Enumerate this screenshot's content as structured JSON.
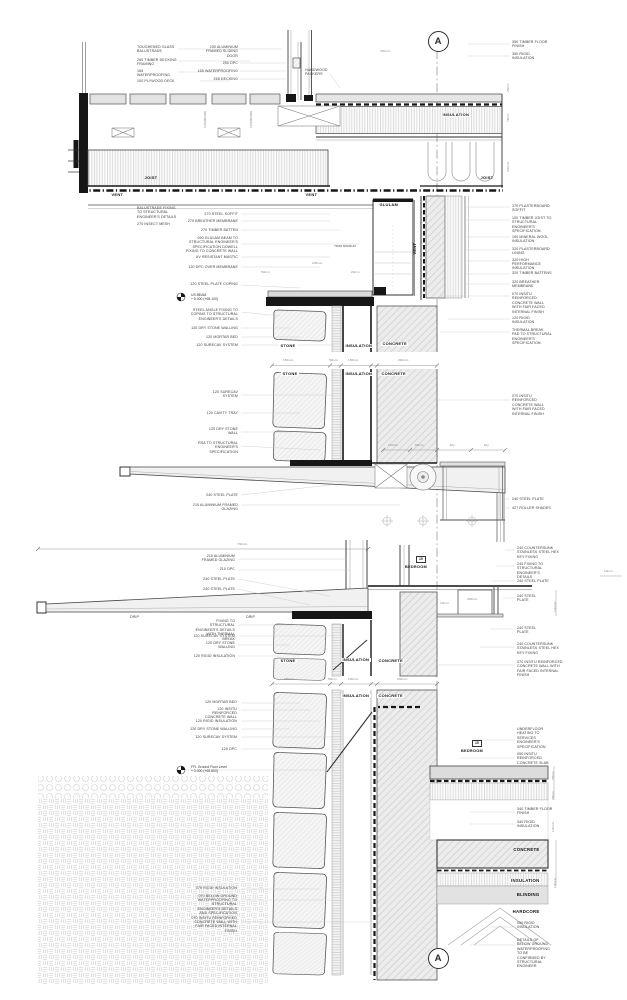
{
  "section_markers": {
    "top": "A",
    "bottom": "A"
  },
  "room": {
    "tag": "15",
    "name": "BEDROOM"
  },
  "material_labels": {
    "joist": "JOIST",
    "vent": "VENT",
    "insulation": "INSULATION",
    "glulam": "GLULAM",
    "stone": "STONE",
    "concrete": "CONCRETE",
    "blinding": "BLINDING",
    "hardcore": "HARDCORE",
    "min_note": "75MM MINIMUM"
  },
  "levels": {
    "us_beam": {
      "l1": "US BEAM",
      "l2": "+ 5.000 (+68.100)"
    },
    "ffl": {
      "l1": "FFL Ground Floor Level",
      "l2": "+ 3.000 (+65.800)"
    }
  },
  "annotations": {
    "deck": {
      "tl1": "TOUGHENED GLASS BALUSTRADE",
      "tl2": "265 TIMBER DECKING FRAMING",
      "tl3": "165 WATERPROOFING",
      "tl4": "100 PLYWOOD DECK",
      "tl5": "BALUSTRADE FIXING TO STRUCTURAL ENGINEER'S DETAILS",
      "tl6": "270 INSECT MESH"
    },
    "door": {
      "tm1": "200 ALUMINIUM FRAMED SLIDING DOOR",
      "tm2": "250 DPC",
      "tm3": "165 WATERPROOFING",
      "tm4": "265 DECKING",
      "tm5": "HARDWOOD PACKERS"
    },
    "floor_top": {
      "tr1": "350 TIMBER FLOOR FINISH",
      "tr2": "350 RIGID INSULATION"
    },
    "wall_right": {
      "r1": "370 PLASTERBOARD SOFFIT",
      "r2": "100 TIMBER JOIST TO STRUCTURAL ENGINEER'S SPECIFICATION",
      "r3": "100 MINERAL WOOL INSULATION",
      "r4": "320 PLASTERBOARD LINING",
      "r5": "320 HIGH PERFORMANCE INSULATION",
      "r6": "320 TIMBER BATTENS",
      "r7": "320 BREATHER MEMBRANE",
      "r8": "070 INSITU REINFORCED CONCRETE WALL WITH FAIR FACED INTERNAL FINISH",
      "r9": "120 RIGID INSULATION",
      "r10": "THERMAL BREAK PAD TO STRUCTURAL ENGINEER'S SPECIFICATION",
      "r11": "070 INSITU REINFORCED CONCRETE WALL WITH FAIR FACED INTERNAL FINISH",
      "r12": "240 STEEL PLATE",
      "r13": "427 ROLLER SHADES"
    },
    "parapet_left": {
      "l1": "270 STEEL SOFFIT",
      "l2": "270 BREATHER MEMBRANE",
      "l3": "270 TIMBER BATTEN",
      "l4": "090 GLULAM BEAM TO STRUCTURAL ENGINEER'S SPECIFICATION DOWELL FIXING TO CONCRETE WALL",
      "l5": "UV RESISTANT MASTIC",
      "l6": "120 DPC OVER MEMBRANE",
      "l7": "120 STEEL PLATE COPING",
      "l8": "STEEL ANGLE FIXING TO COPING TO STRUCTURAL ENGINEER'S DETAILS",
      "l9": "120 DRY STONE WALLING",
      "l10": "120 MORTAR BED",
      "l11": "120 SURECAV SYSTEM"
    },
    "stone_wall_left": {
      "s1": "120 SURECAV SYSTEM",
      "s2": "120 CAVITY TRAY",
      "s3": "120 DRY STONE WALL",
      "s4": "RSA TO STRUCTURAL ENGINEER'S SPECIFICATION"
    },
    "canopy": {
      "c1": "240 STEEL PLATE",
      "c2": "210 ALUMINIUM FRAMED GLAZING"
    },
    "canopy2_left": {
      "d1": "210 ALUMINIUM FRAMED GLAZING",
      "d2": "210 DPC",
      "d3": "240 STEEL PLATE",
      "d4": "240 STEEL PLATE",
      "drip": "DRIP",
      "d6": "FIXING TO STRUCTURAL ENGINEER'S DETAILS WITH THERMAL BREAK",
      "d7": "120 SURECAV SYSTEM",
      "d8": "120 DRY STONE WALLING",
      "d9": "120 RIGID INSULATION"
    },
    "canopy2_right": {
      "e1": "240 COUNTERSUNK STAINLESS STEEL HEX KEY FIXING",
      "e2": "240 FIXING TO STRUCTURAL ENGINEER'S DETAILS",
      "e3": "240 STEEL PLATE",
      "e4": "240 STEEL PLATE",
      "e5": "240 STEEL PLATE",
      "e6": "240 COUNTERSUNK STAINLESS STEEL HEX KEY FIXING",
      "e7": "070 INSITU REINFORCED CONCRETE WALL WITH FAIR FACED INTERNAL FINISH"
    },
    "ground_left": {
      "b1": "120 MORTAR BED",
      "b2": "120 INSITU REINFORCED CONCRETE WALL",
      "b3": "120 RIGID INSULATION",
      "b4": "120 DRY STONE WALLING",
      "b5": "120 SURECAV SYSTEM",
      "b6": "120 DPC",
      "b7": "070 RIGID INSULATION",
      "b8": "070 BELOW GROUND WATERPROOFING TO STRUCTURAL ENGINEER'S DETAILS AND SPECIFICATION",
      "b9": "070 INSITU REINFORCED CONCRETE WALL WITH FAIR FACED INTERNAL FINISH"
    },
    "ground_right": {
      "g1": "UNDERFLOOR HEATING TO SERVICES ENGINEER'S SPECIFICATION",
      "g2": "050 INSITU REINFORCED CONCRETE SLAB",
      "g3": "340 TIMBER FLOOR FINISH",
      "g4": "340 RIGID INSULATION",
      "g5": "050 RIGID INSULATION",
      "g6": "DETAILS OF BELOW GROUND WATERPROOFING TO BE CONFIRMED BY STRUCTURAL ENGINEER"
    }
  },
  "dimensions": {
    "d330": "330mm",
    "d25": "25mm",
    "d75": "75mm",
    "d200": "200mm",
    "d100min": "100MM MIN",
    "d150": "150mm",
    "d50": "50mm",
    "d100": "100mm",
    "d110": "110mm",
    "d90": "90mm",
    "eq": "EQ",
    "d730": "730mm",
    "d10": "10mm",
    "d20": "20mm",
    "d235": "235mm"
  }
}
